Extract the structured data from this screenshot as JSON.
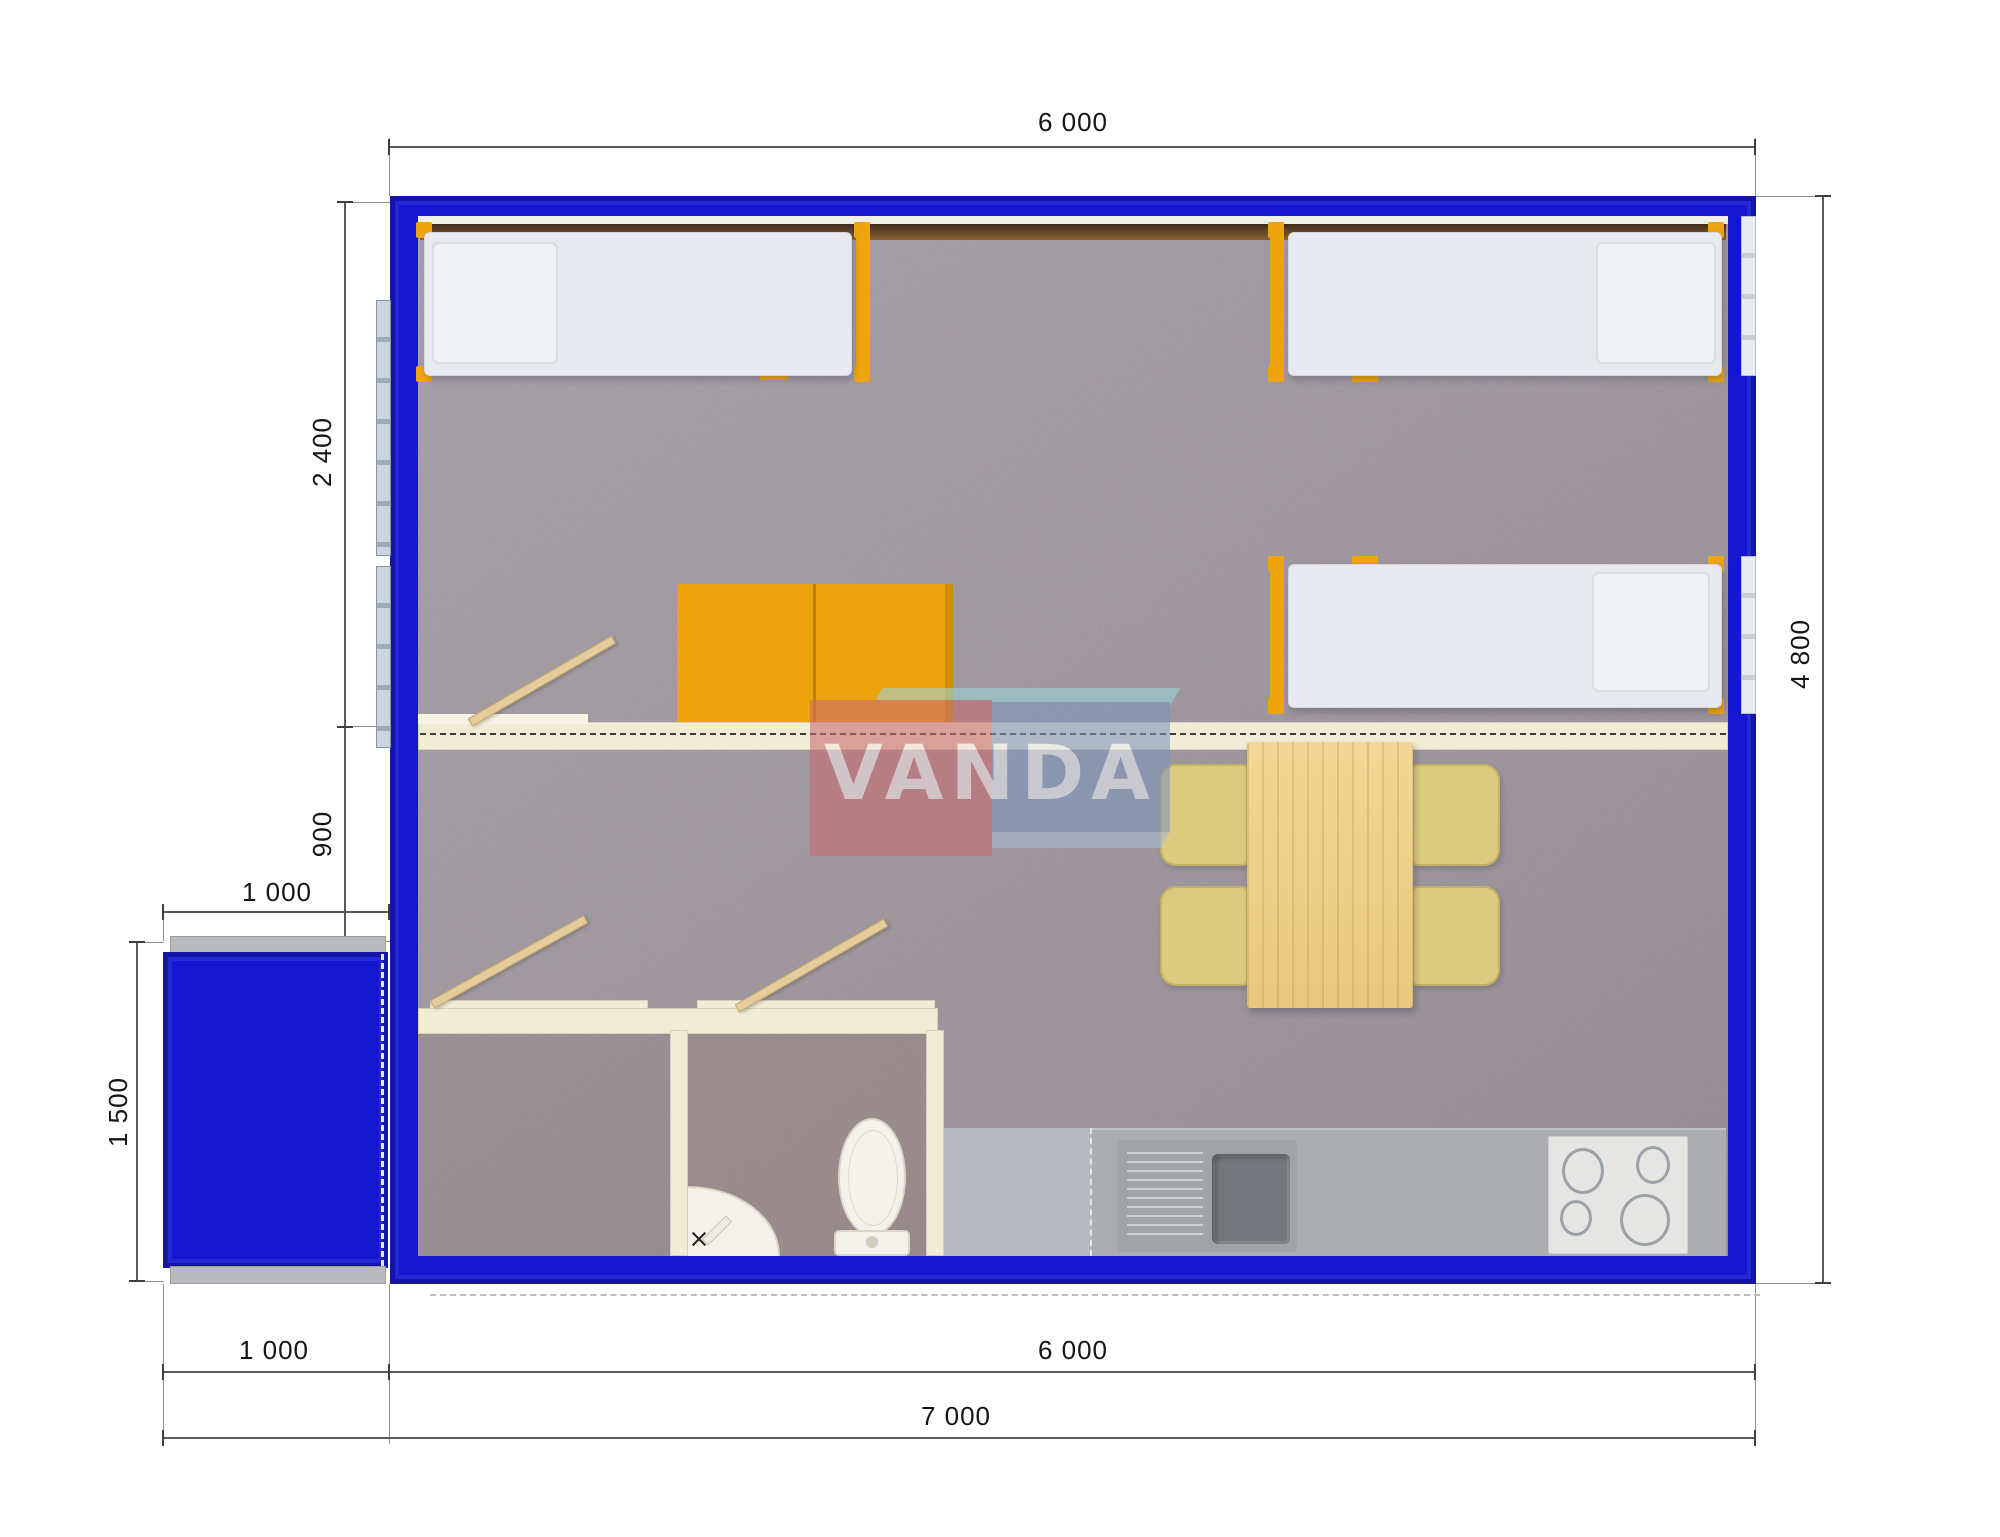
{
  "watermark": {
    "text": "VANDA"
  },
  "dimensions": {
    "top_width": "6 000",
    "bedroom_depth": "2 400",
    "hall_depth": "900",
    "porch_width": "1 000",
    "porch_depth": "1 500",
    "overall_depth": "4 800",
    "bottom_porch_width": "1 000",
    "bottom_main_width": "6 000",
    "overall_width": "7 000"
  },
  "colors": {
    "wall_blue": "#1517CE",
    "furniture_orange": "#EEA40F",
    "wood": "#F0D28F",
    "chair_tan": "#DBCB7E",
    "partition_cream": "#F1ECD6",
    "carpet_gray": "#A9A2A8",
    "counter_gray": "#ACADB1",
    "logo_red": "#C96B70",
    "logo_blue": "#7D95BC",
    "logo_teal": "#9AD4DB"
  }
}
